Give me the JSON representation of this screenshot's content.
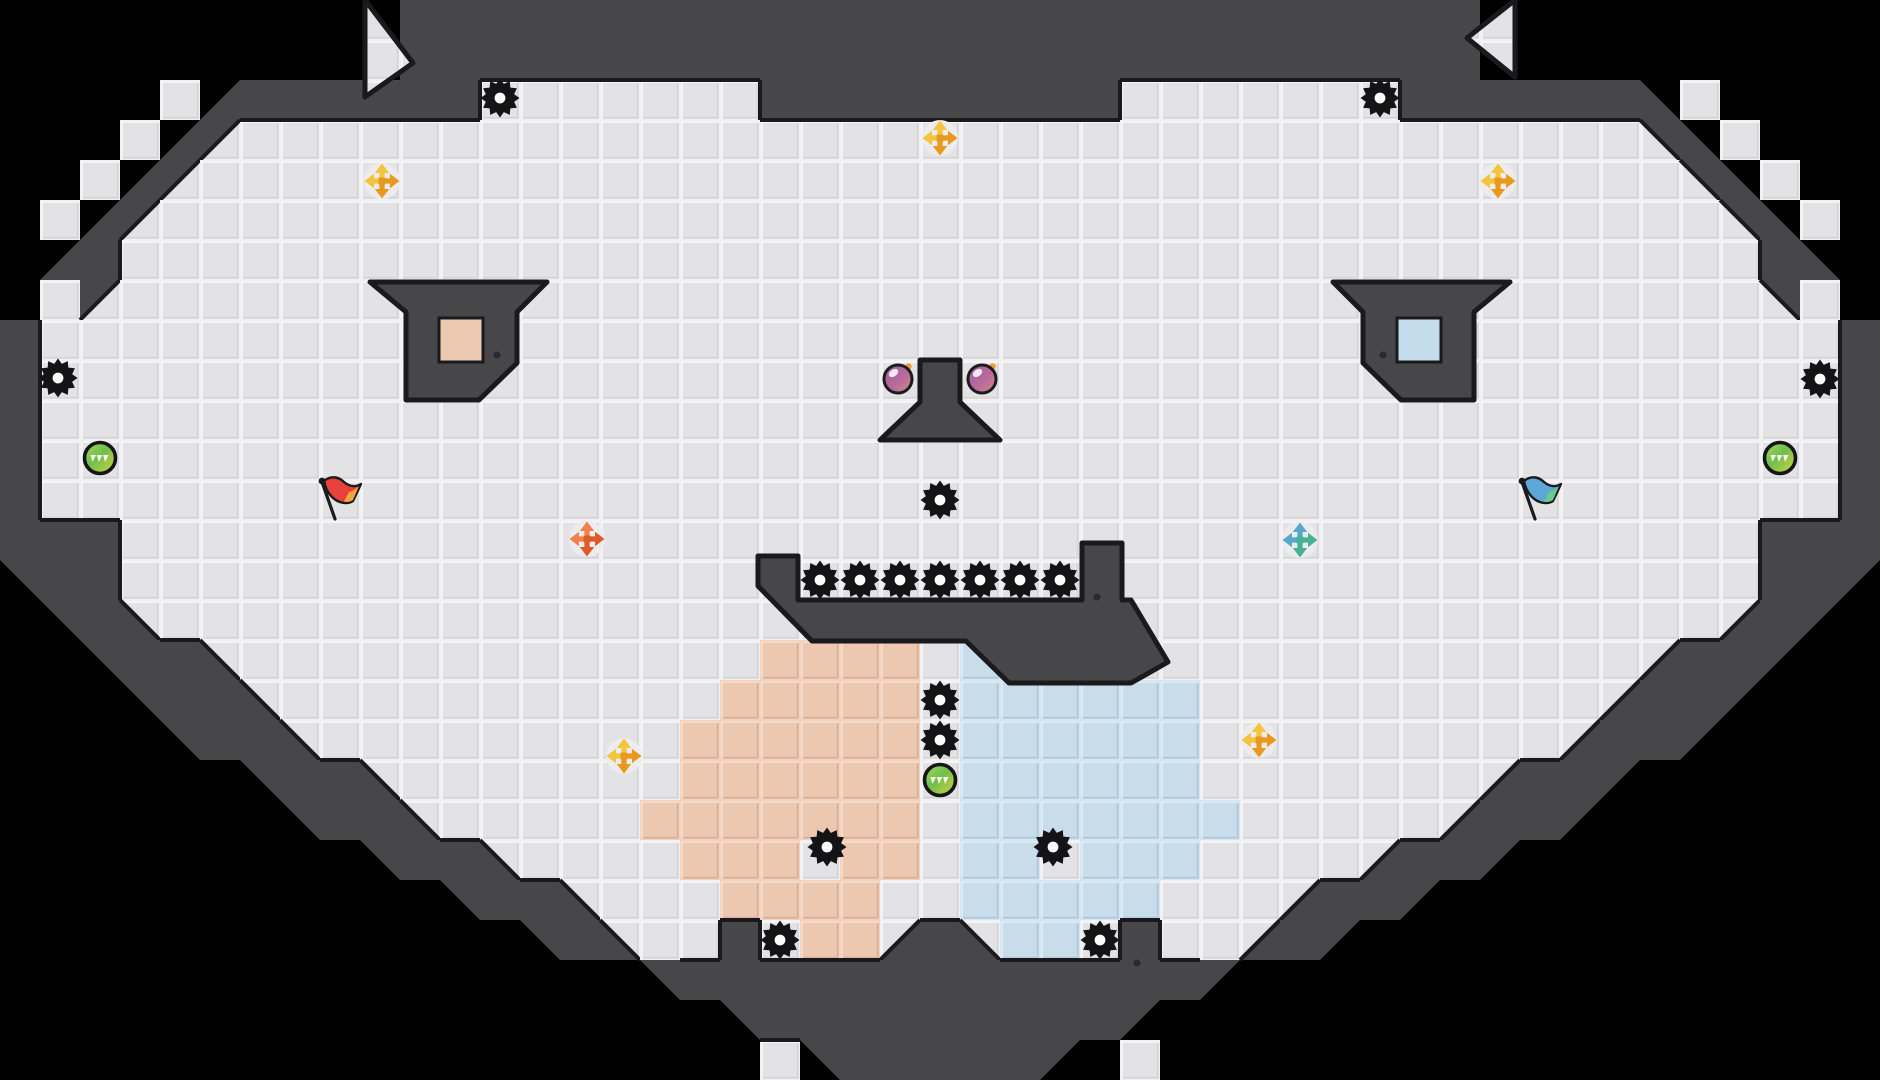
{
  "canvas": {
    "width": 1880,
    "height": 1080,
    "tile": 40
  },
  "colors": {
    "background": "#000000",
    "wall": "#47474a",
    "edge": "#1a1a1d",
    "screw": "#2a2a2e",
    "floor_line": "#f1f1f3",
    "floor_base": "#e3e3e6",
    "floor_shade": "#d6d6d9",
    "floor_hl": "#f6f6f8",
    "peach_line": "#f2d3c0",
    "peach_base": "#ecc8b1",
    "peach_shade": "#dcb199",
    "peach_hl": "#f5dbca",
    "blue_line": "#d6e5f0",
    "blue_base": "#c8dcea",
    "blue_shade": "#b2cadb",
    "blue_hl": "#dcebf5",
    "gear": "#141416",
    "gear_hole": "#fafafa",
    "green_orb_1": "#a6dc60",
    "green_orb_2": "#6fbf4a",
    "green_orb_3": "#d6d443",
    "orb_ring": "#161618",
    "purple_1": "#9a63a8",
    "purple_2": "#b96a9b",
    "purple_3": "#cf8b84",
    "purple_spark": "#f09a30",
    "plus_disc": "#ececee",
    "eye_square_left": "#eccab2",
    "eye_square_right": "#c5dcec",
    "flag_red_body": "#e8413c",
    "flag_red_tip": "#f5a33b",
    "flag_blue_body": "#5aa7d8",
    "flag_blue_tip": "#6cc98f",
    "pole": "#1b1b1d"
  },
  "plus_variants": {
    "yellow": {
      "a": "#f6c33c",
      "b": "#e8991c"
    },
    "orange": {
      "a": "#f0814d",
      "b": "#e05a28"
    },
    "teal": {
      "a": "#55a8cc",
      "b": "#47b196"
    }
  },
  "grid": {
    "cols": 47,
    "rows": 27,
    "left_half": [
      "KKKKKKKKKKDDDDDDDDDDDDD",
      "KKKKKKKKKKDDDDDDDDDDDDD",
      "KKKK.HDDDDDD.......DDDD",
      "KKK.Hb.................",
      "KK.Hb..................",
      "K.Hb...................",
      "KHD....................",
      "K.b....................",
      "D......................",
      "D......................",
      "D......................",
      "D......................",
      "D......................",
      "DDD....................",
      "EDD....................",
      "KEDc...................",
      "KKEDDc.............PPPP",
      "KKKEDDc...........PPPPP",
      "KKKKEDDc.........PPPPPP",
      "KKKKKKEDDc.......PPPPPP",
      "KKKKKKKEDDc.....PPPPPPP",
      "KKKKKKKKKEDDc....PPP.PP",
      "KKKKKKKKKKKEDDc...PPPP.",
      "KKKKKKKKKKKKKEDc..D.PPd",
      "KKKKKKKKKKKKKKKKEDDDDDD",
      "KKKKKKKKKKKKKKKKKKEDDDD",
      "KKKKKKKKKKKKKKKKKKK.EDD"
    ],
    "center_col": "DDD....................DDDD",
    "mirror_map": {
      "P": "B",
      "B": "P",
      "a": "b",
      "b": "a",
      "c": "d",
      "d": "c",
      "E": "F",
      "F": "E",
      "G": "H",
      "H": "G"
    },
    "patches": [
      {
        "r": 22,
        "c": 24,
        "ch": "B"
      },
      {
        "r": 17,
        "c": 29,
        "ch": "B"
      },
      {
        "r": 26,
        "c": 27,
        "ch": "K"
      },
      {
        "r": 26,
        "c": 28,
        "ch": "."
      }
    ]
  },
  "features": {
    "wall_polys": [
      {
        "name": "left-eye",
        "points": [
          [
            370,
            282
          ],
          [
            547,
            282
          ],
          [
            517,
            312
          ],
          [
            517,
            363
          ],
          [
            479,
            400
          ],
          [
            406,
            400
          ],
          [
            406,
            312
          ]
        ]
      },
      {
        "name": "right-eye",
        "points": [
          [
            1510,
            282
          ],
          [
            1333,
            282
          ],
          [
            1363,
            312
          ],
          [
            1363,
            363
          ],
          [
            1401,
            400
          ],
          [
            1474,
            400
          ],
          [
            1474,
            312
          ]
        ]
      },
      {
        "name": "nose",
        "points": [
          [
            920,
            360
          ],
          [
            960,
            360
          ],
          [
            960,
            402
          ],
          [
            1000,
            440
          ],
          [
            880,
            440
          ],
          [
            920,
            402
          ]
        ]
      },
      {
        "name": "mouth",
        "points": [
          [
            758,
            556
          ],
          [
            798,
            556
          ],
          [
            798,
            600
          ],
          [
            1082,
            600
          ],
          [
            1082,
            543
          ],
          [
            1122,
            543
          ],
          [
            1122,
            600
          ],
          [
            1131,
            600
          ],
          [
            1168,
            662
          ],
          [
            1131,
            683
          ],
          [
            1009,
            683
          ],
          [
            966,
            641
          ],
          [
            812,
            641
          ],
          [
            758,
            586
          ]
        ]
      }
    ],
    "floor_notches": [
      {
        "name": "top-left-notch",
        "points": [
          [
            365,
            0
          ],
          [
            413,
            63
          ],
          [
            365,
            97
          ]
        ]
      },
      {
        "name": "top-right-notch",
        "points": [
          [
            1515,
            0
          ],
          [
            1467,
            38
          ],
          [
            1515,
            77
          ]
        ]
      }
    ],
    "eye_squares": [
      {
        "name": "left-eye-square",
        "x": 439,
        "y": 318,
        "w": 44,
        "h": 44,
        "fill_key": "eye_square_left"
      },
      {
        "name": "right-eye-square",
        "x": 1397,
        "y": 318,
        "w": 44,
        "h": 44,
        "fill_key": "eye_square_right"
      }
    ],
    "screw_dots": [
      [
        497,
        355
      ],
      [
        1383,
        355
      ],
      [
        1097,
        597
      ],
      [
        1137,
        963
      ]
    ]
  },
  "entities": {
    "gears": [
      {
        "x": 500,
        "y": 98
      },
      {
        "x": 1380,
        "y": 98
      },
      {
        "x": 58,
        "y": 378
      },
      {
        "x": 1820,
        "y": 379
      },
      {
        "x": 820,
        "y": 580
      },
      {
        "x": 860,
        "y": 580
      },
      {
        "x": 900,
        "y": 580
      },
      {
        "x": 940,
        "y": 580
      },
      {
        "x": 980,
        "y": 580
      },
      {
        "x": 1020,
        "y": 580
      },
      {
        "x": 1060,
        "y": 580
      },
      {
        "x": 940,
        "y": 500
      },
      {
        "x": 940,
        "y": 700
      },
      {
        "x": 940,
        "y": 740
      },
      {
        "x": 827,
        "y": 847
      },
      {
        "x": 1053,
        "y": 847
      },
      {
        "x": 780,
        "y": 940
      },
      {
        "x": 1100,
        "y": 940
      }
    ],
    "green_orbs": [
      {
        "x": 100,
        "y": 458
      },
      {
        "x": 1780,
        "y": 458
      },
      {
        "x": 940,
        "y": 780
      }
    ],
    "purple_orbs": [
      {
        "x": 898,
        "y": 379
      },
      {
        "x": 982,
        "y": 379
      }
    ],
    "plus_pickups": [
      {
        "x": 382,
        "y": 181,
        "variant": "yellow"
      },
      {
        "x": 1498,
        "y": 181,
        "variant": "yellow"
      },
      {
        "x": 940,
        "y": 138,
        "variant": "yellow"
      },
      {
        "x": 624,
        "y": 756,
        "variant": "yellow"
      },
      {
        "x": 1259,
        "y": 740,
        "variant": "yellow"
      },
      {
        "x": 587,
        "y": 539,
        "variant": "orange"
      },
      {
        "x": 1300,
        "y": 540,
        "variant": "teal"
      }
    ],
    "flags": [
      {
        "x": 335,
        "y": 519,
        "variant": "red"
      },
      {
        "x": 1535,
        "y": 519,
        "variant": "blue"
      }
    ]
  }
}
